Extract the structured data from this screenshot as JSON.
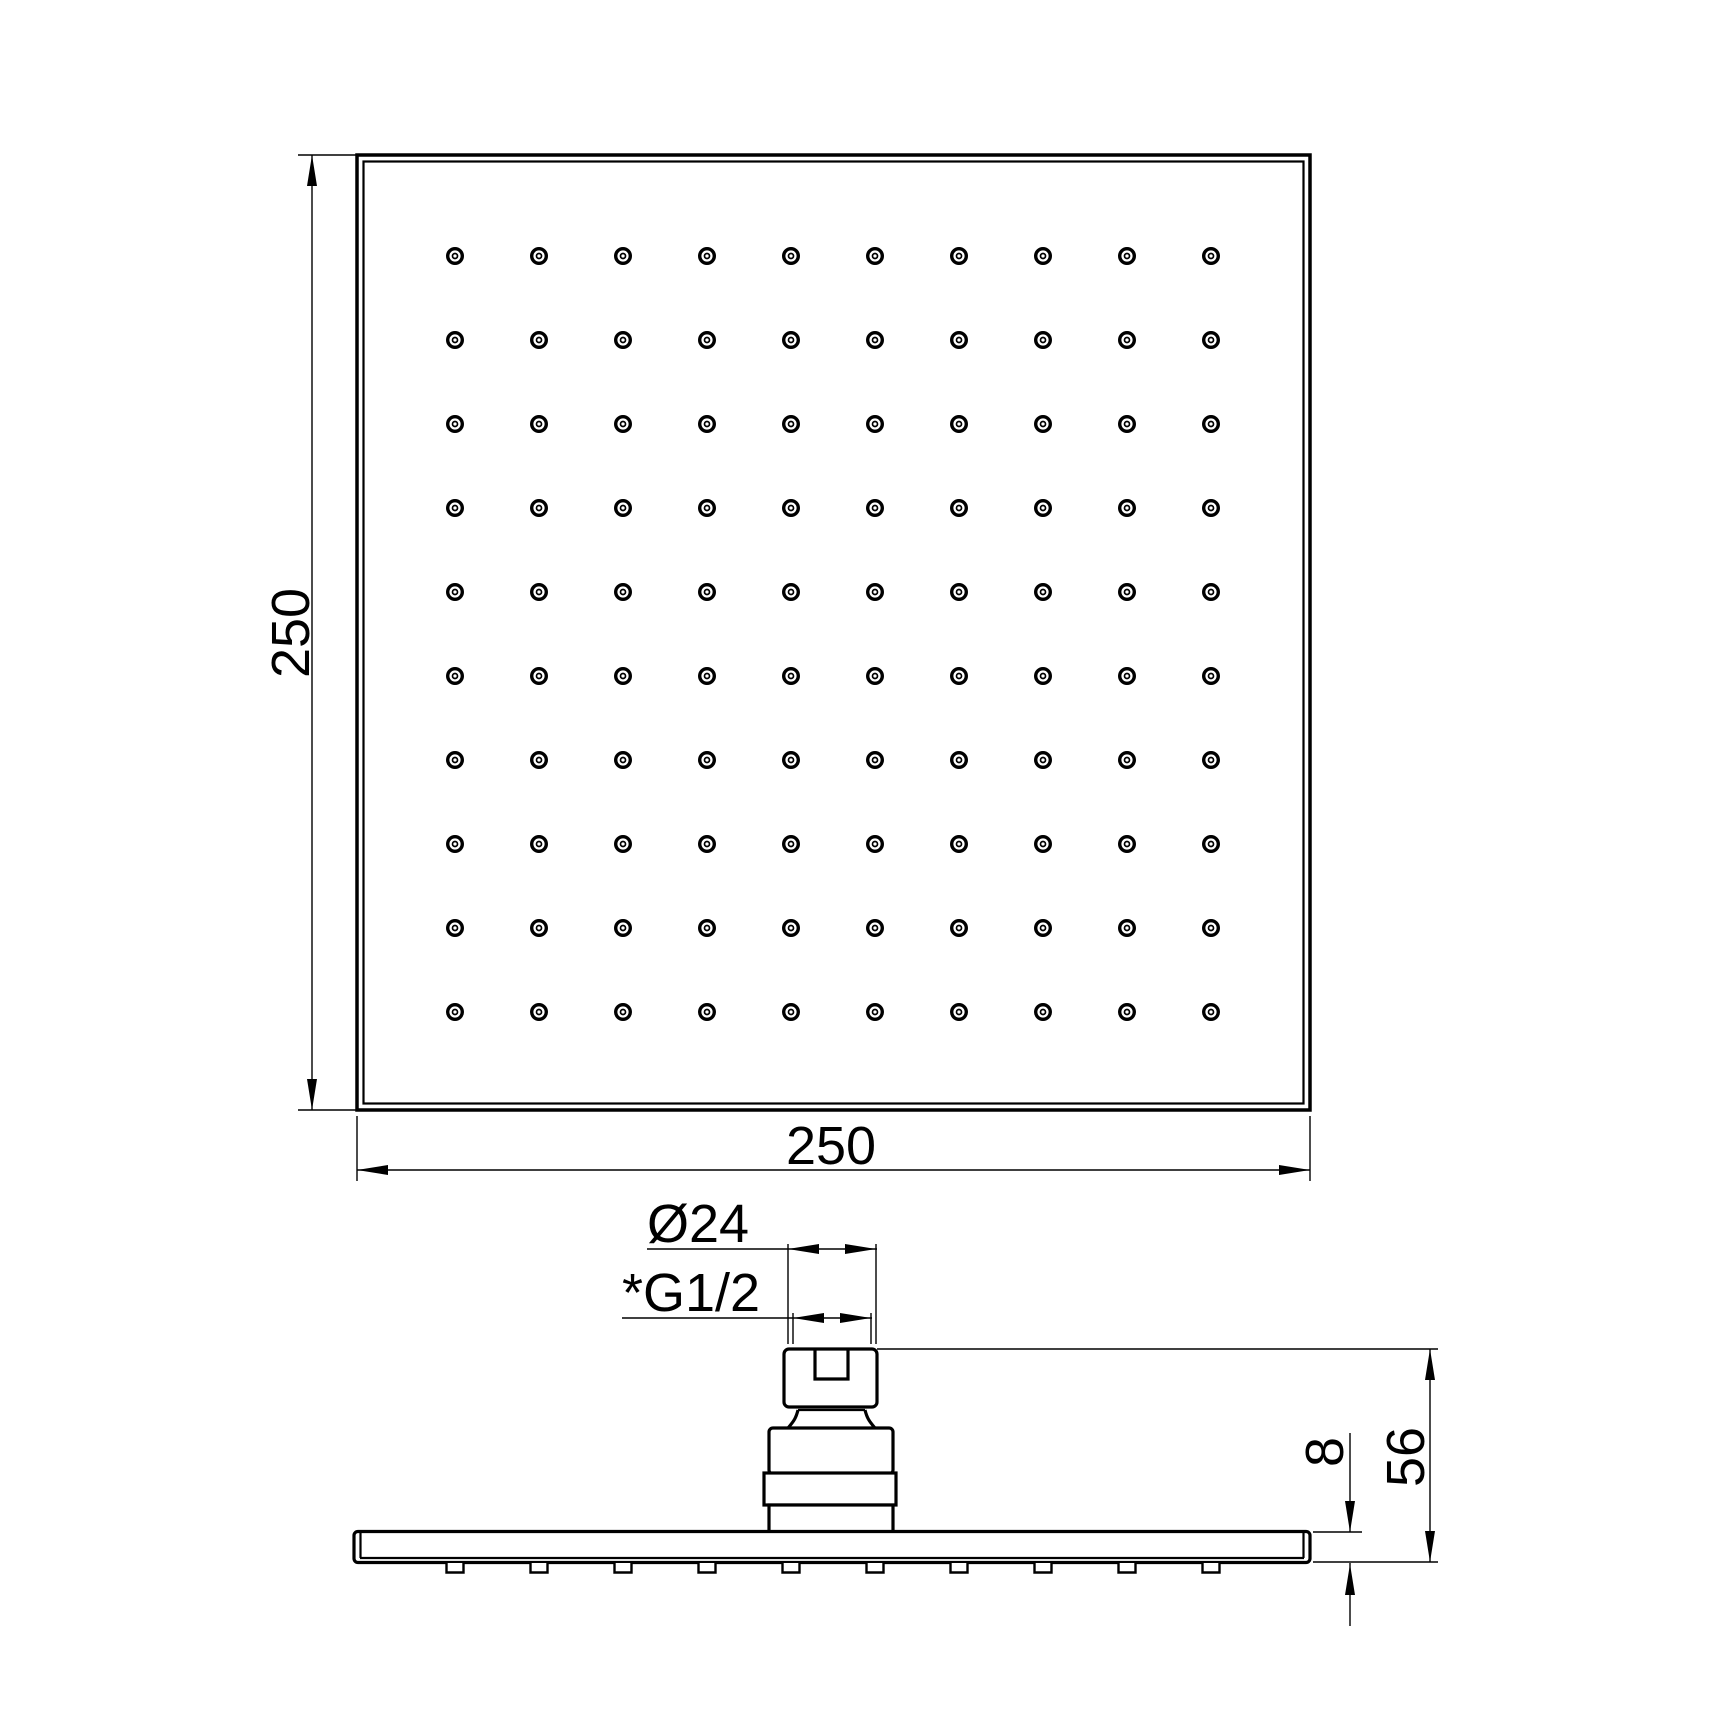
{
  "drawing": {
    "type": "technical-dimension-drawing",
    "subject": "square-rain-shower-head",
    "background_color": "#ffffff",
    "line_color": "#000000",
    "top_view": {
      "width_label": "250",
      "height_label": "250",
      "nozzle_grid": {
        "rows": 10,
        "cols": 10
      }
    },
    "side_view": {
      "connector_diameter_label": "Ø24",
      "thread_label": "*G1/2",
      "total_height_label": "56",
      "plate_thickness_label": "8",
      "bump_count": 10
    }
  }
}
